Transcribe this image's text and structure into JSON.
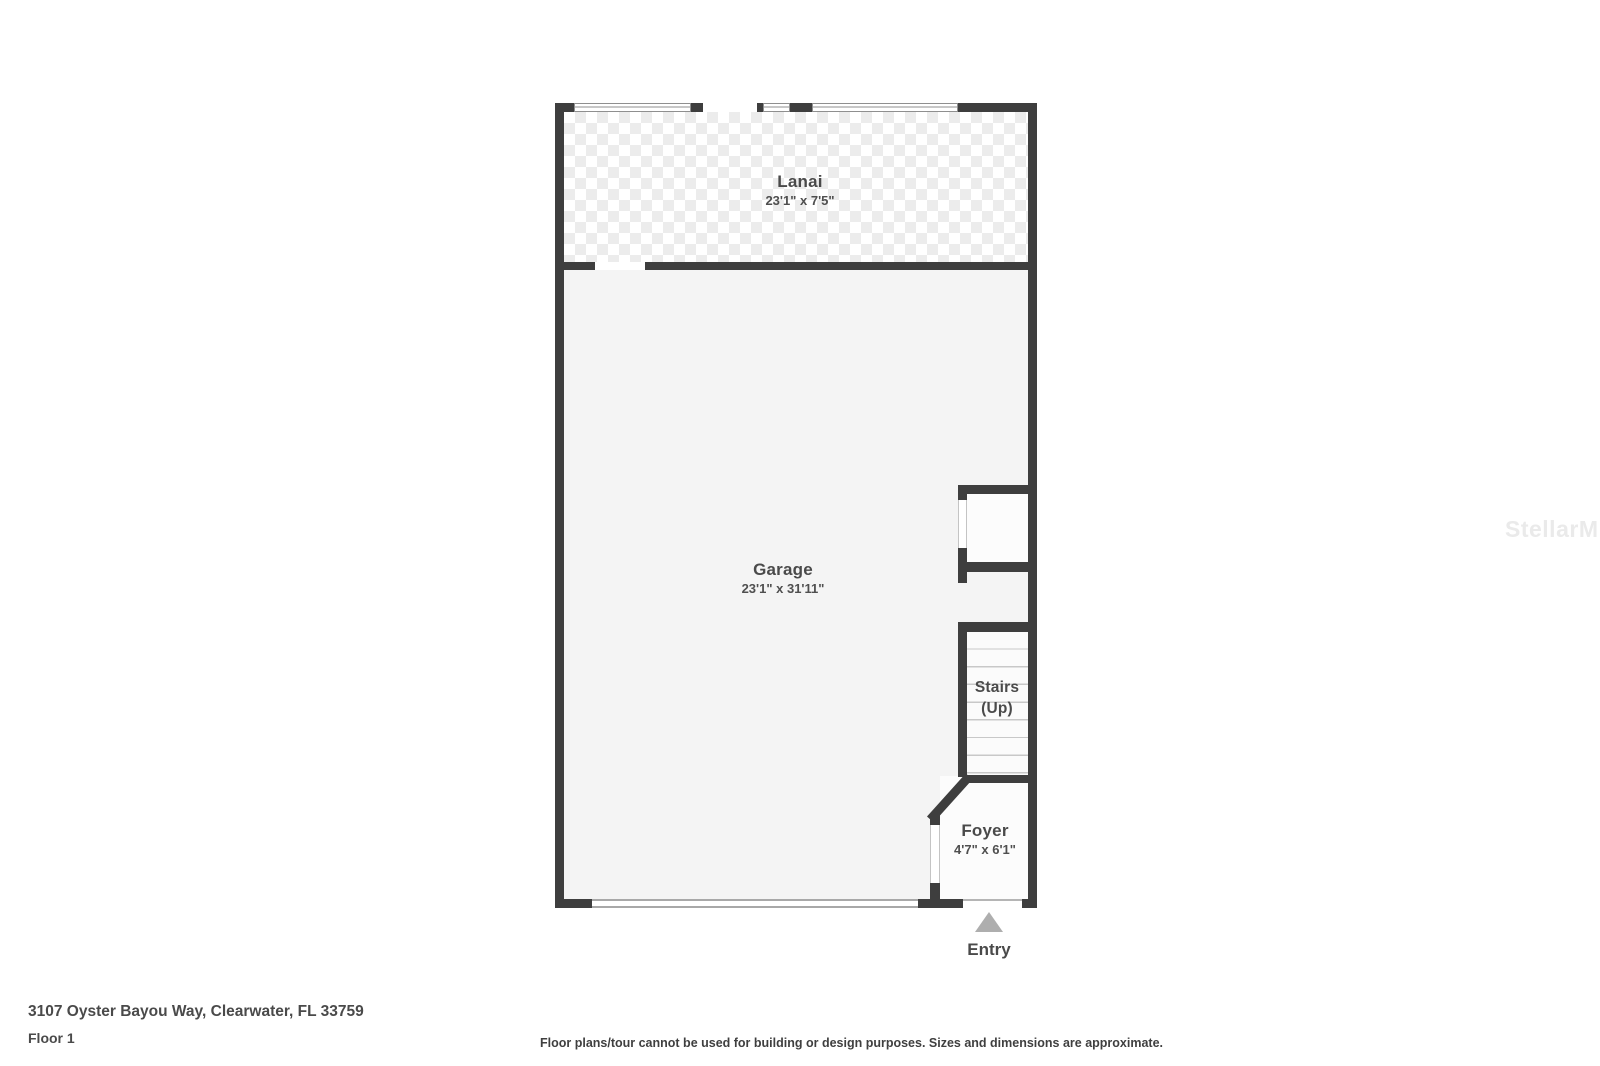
{
  "plan": {
    "rooms": {
      "lanai": {
        "name": "Lanai",
        "dims": "23'1\" x 7'5\""
      },
      "garage": {
        "name": "Garage",
        "dims": "23'1\" x 31'11\""
      },
      "stairs": {
        "name": "Stairs",
        "direction": "(Up)"
      },
      "foyer": {
        "name": "Foyer",
        "dims": "4'7\" x 6'1\""
      }
    },
    "entry": {
      "label": "Entry"
    }
  },
  "footer": {
    "address": "3107 Oyster Bayou Way, Clearwater, FL 33759",
    "floor": "Floor 1",
    "disclaimer": "Floor plans/tour cannot be used for building or design purposes. Sizes and dimensions are approximate."
  },
  "watermark": "StellarMLS",
  "colors": {
    "wall": "#3e3e3e",
    "garage_fill": "#f4f4f4",
    "room_fill": "#fcfcfc",
    "lanai_tile": "#ececec",
    "label_text": "#4a4a4a",
    "stair_tread": "#c8c8c8",
    "entry_arrow": "#aeaeae",
    "watermark": "#eaeaea"
  }
}
